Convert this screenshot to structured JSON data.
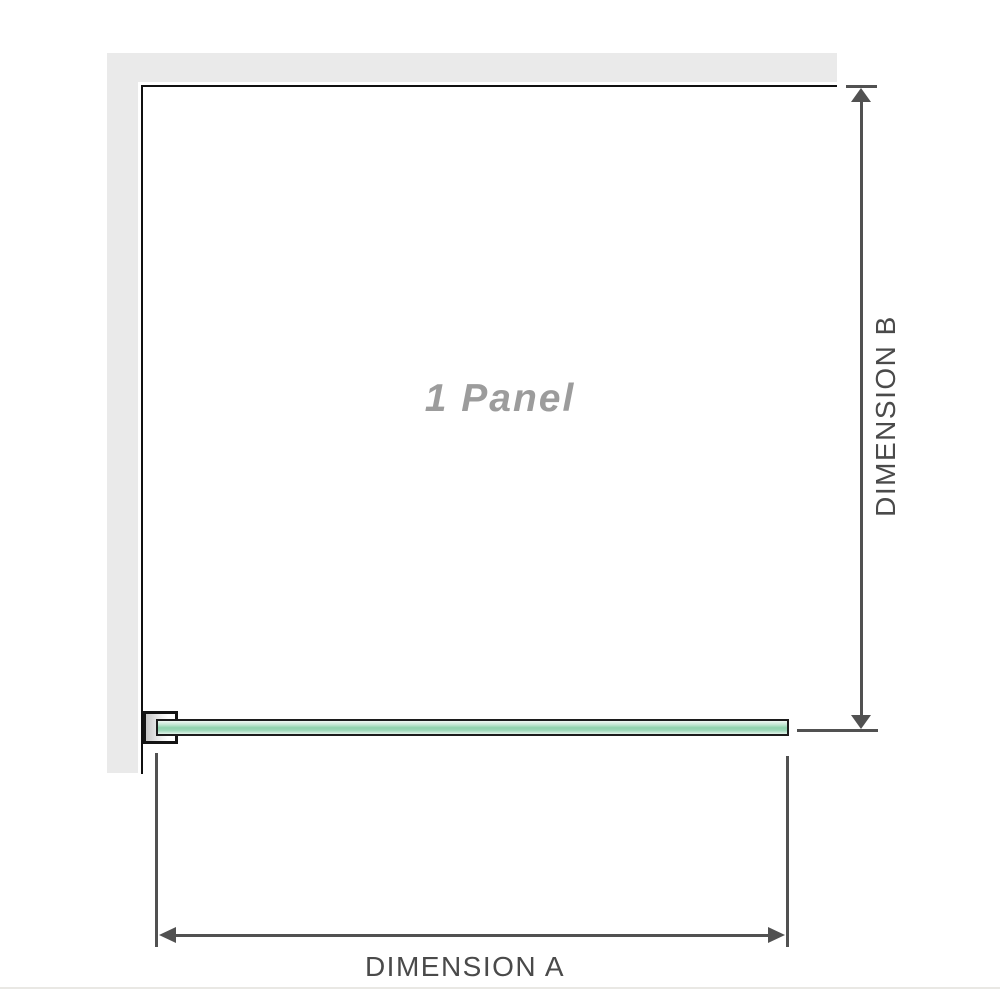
{
  "diagram": {
    "panel": {
      "label": "1 Panel"
    },
    "dimension_a": {
      "label": "DIMENSION A"
    },
    "dimension_b": {
      "label": "DIMENSION B"
    },
    "colors": {
      "wall": "#eaeaea",
      "panel_outline": "#101010",
      "dimension_lines": "#515151",
      "dimension_text": "#4a4a4a",
      "panel_label_text": "#9c9c9c",
      "glass_green": "#8fd3ad",
      "glass_border": "#1c1c1c",
      "bottom_divider": "#e9e8e4"
    }
  }
}
